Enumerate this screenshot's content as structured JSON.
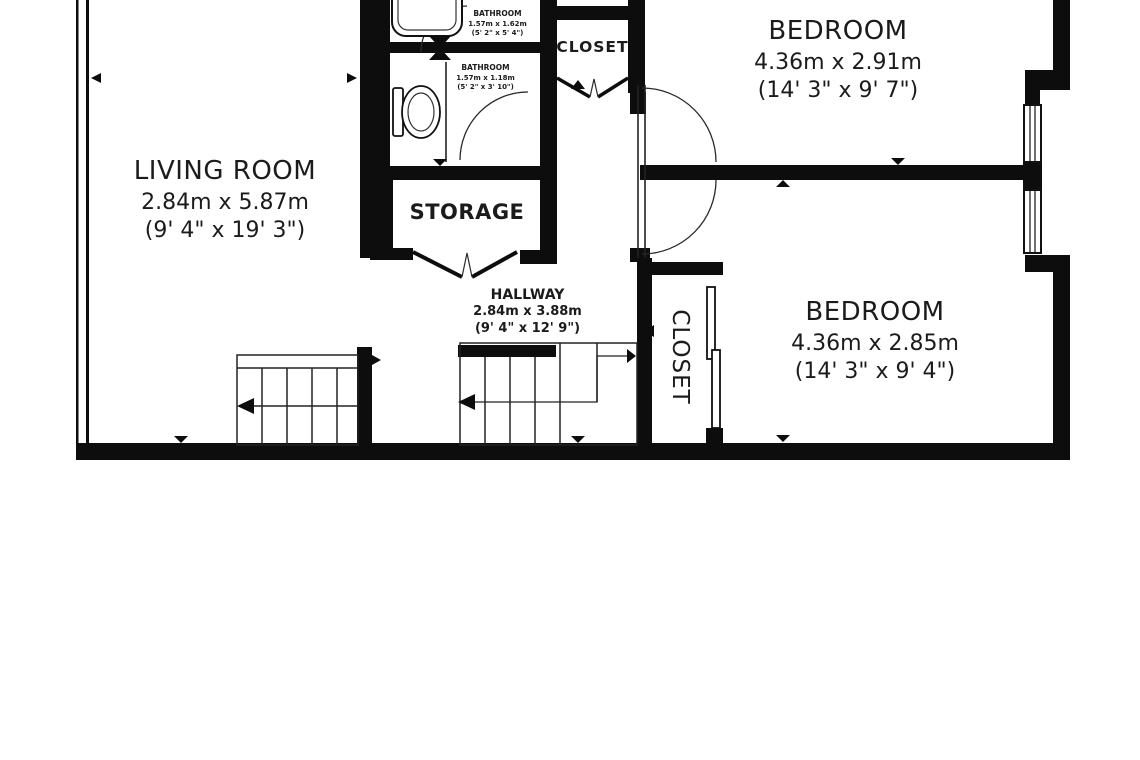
{
  "plan": {
    "background": "#ffffff",
    "wall_color": "#0d0d0d",
    "line_color": "#2a2a2a",
    "rooms": {
      "living_room": {
        "name": "LIVING ROOM",
        "metric": "2.84m x 5.87m",
        "imperial": "(9' 4\" x 19' 3\")"
      },
      "bedroom_top": {
        "name": "BEDROOM",
        "metric": "4.36m x 2.91m",
        "imperial": "(14' 3\" x 9' 7\")"
      },
      "bedroom_bottom": {
        "name": "BEDROOM",
        "metric": "4.36m x 2.85m",
        "imperial": "(14' 3\" x 9' 4\")"
      },
      "hallway": {
        "name": "HALLWAY",
        "metric": "2.84m x 3.88m",
        "imperial": "(9' 4\" x 12' 9\")"
      },
      "bathroom_top": {
        "name": "BATHROOM",
        "metric": "1.57m x 1.62m",
        "imperial": "(5' 2\" x 5' 4\")"
      },
      "bathroom_mid": {
        "name": "BATHROOM",
        "metric": "1.57m x 1.18m",
        "imperial": "(5' 2\" x 3' 10\")"
      },
      "storage": {
        "name": "STORAGE"
      },
      "closet_top": {
        "name": "CLOSET"
      },
      "closet_side": {
        "name": "CLOSET"
      }
    }
  }
}
